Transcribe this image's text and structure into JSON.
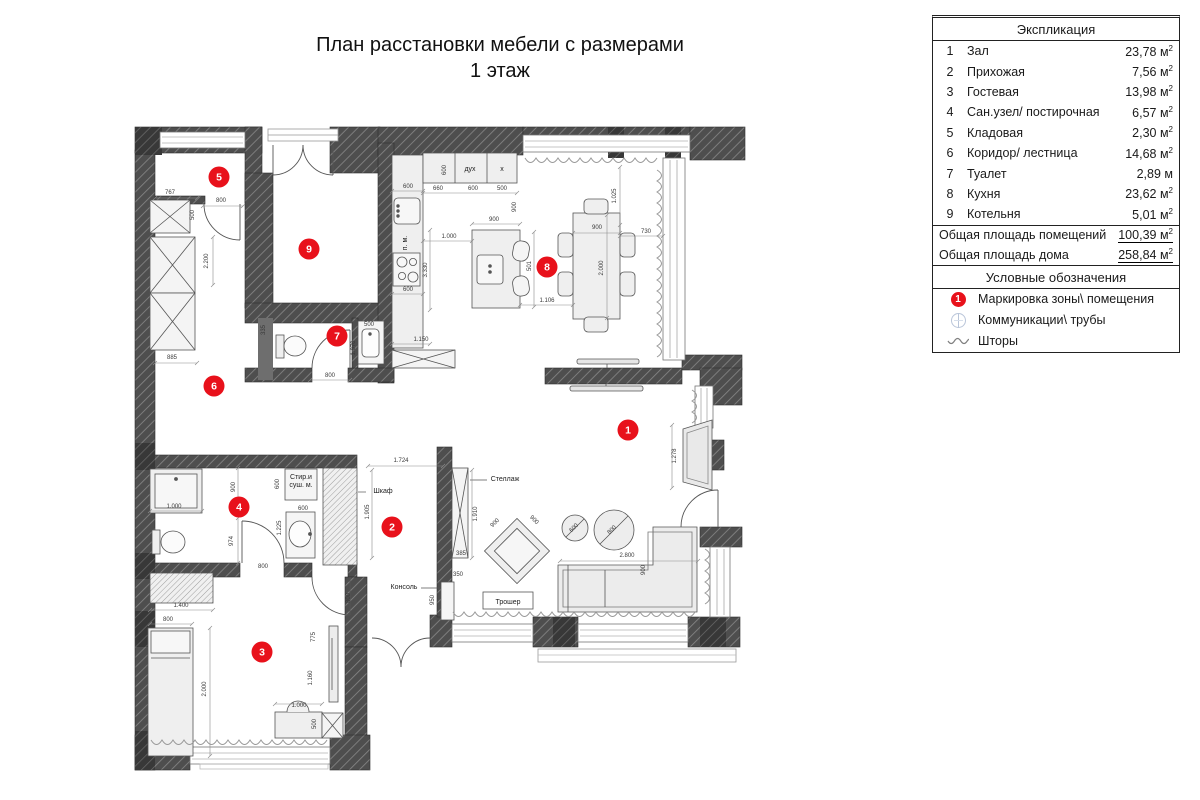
{
  "title": {
    "line1": "План расстановки мебели с размерами",
    "line2": "1 этаж"
  },
  "explication": {
    "header": "Экспликация",
    "rows": [
      {
        "num": "1",
        "name": "Зал",
        "area": "23,78",
        "unit": "м",
        "sup": "2"
      },
      {
        "num": "2",
        "name": "Прихожая",
        "area": "7,56",
        "unit": "м",
        "sup": "2"
      },
      {
        "num": "3",
        "name": "Гостевая",
        "area": "13,98",
        "unit": "м",
        "sup": "2"
      },
      {
        "num": "4",
        "name": "Сан.узел/ постирочная",
        "area": "6,57",
        "unit": "м",
        "sup": "2"
      },
      {
        "num": "5",
        "name": "Кладовая",
        "area": "2,30",
        "unit": "м",
        "sup": "2"
      },
      {
        "num": "6",
        "name": "Коридор/ лестница",
        "area": "14,68",
        "unit": "м",
        "sup": "2"
      },
      {
        "num": "7",
        "name": "Туалет",
        "area": "2,89",
        "unit": "м",
        "sup": ""
      },
      {
        "num": "8",
        "name": "Кухня",
        "area": "23,62",
        "unit": "м",
        "sup": "2"
      },
      {
        "num": "9",
        "name": "Котельня",
        "area": "5,01",
        "unit": "м",
        "sup": "2"
      }
    ],
    "totals": [
      {
        "label": "Общая площадь помещений",
        "value": "100,39",
        "unit": "м",
        "sup": "2"
      },
      {
        "label": "Общая площадь дома",
        "value": "258,84",
        "unit": "м",
        "sup": "2"
      }
    ]
  },
  "legend": {
    "header": "Условные обозначения",
    "items": [
      {
        "icon": "zone-marker",
        "label": "Маркировка зоны\\ помещения"
      },
      {
        "icon": "pipes",
        "label": "Коммуникации\\ трубы"
      },
      {
        "icon": "curtains",
        "label": "Шторы"
      }
    ]
  },
  "colors": {
    "zone_marker": "#e8111b",
    "wall": "#4e4e4e",
    "furniture": "#efefef"
  },
  "plan": {
    "zones": [
      {
        "n": "1",
        "x": 628,
        "y": 430
      },
      {
        "n": "2",
        "x": 392,
        "y": 527
      },
      {
        "n": "3",
        "x": 262,
        "y": 652
      },
      {
        "n": "4",
        "x": 239,
        "y": 507
      },
      {
        "n": "5",
        "x": 219,
        "y": 177
      },
      {
        "n": "6",
        "x": 214,
        "y": 386
      },
      {
        "n": "7",
        "x": 337,
        "y": 336
      },
      {
        "n": "8",
        "x": 547,
        "y": 267
      },
      {
        "n": "9",
        "x": 309,
        "y": 249
      }
    ],
    "labels": [
      {
        "t": "Шкаф",
        "x": 383,
        "y": 493,
        "r": 0
      },
      {
        "t": "Консоль",
        "x": 404,
        "y": 589,
        "r": 0
      },
      {
        "t": "Стеллаж",
        "x": 505,
        "y": 481,
        "r": 0
      },
      {
        "t": "Трошер",
        "x": 508,
        "y": 604,
        "r": 0
      },
      {
        "t": "дух",
        "x": 470,
        "y": 171,
        "r": 0
      },
      {
        "t": "х",
        "x": 502,
        "y": 171,
        "r": 0
      },
      {
        "t": "Стир.и",
        "x": 301,
        "y": 479,
        "r": 0
      },
      {
        "t": "суш. м.",
        "x": 301,
        "y": 487,
        "r": 0
      },
      {
        "t": "п. м.",
        "x": 407,
        "y": 243,
        "r": -90
      }
    ],
    "dims": [
      {
        "t": "767",
        "x": 170,
        "y": 194,
        "r": 0
      },
      {
        "t": "800",
        "x": 221,
        "y": 202,
        "r": 0
      },
      {
        "t": "500",
        "x": 194,
        "y": 215,
        "r": -90
      },
      {
        "t": "2.200",
        "x": 208,
        "y": 261,
        "r": -90
      },
      {
        "t": "885",
        "x": 172,
        "y": 359,
        "r": 0
      },
      {
        "t": "335",
        "x": 265,
        "y": 330,
        "r": -90
      },
      {
        "t": "800",
        "x": 330,
        "y": 377,
        "r": 0
      },
      {
        "t": "500",
        "x": 369,
        "y": 326,
        "r": 0
      },
      {
        "t": "1.070",
        "x": 355,
        "y": 348,
        "r": -90
      },
      {
        "t": "600",
        "x": 408,
        "y": 188,
        "r": 0
      },
      {
        "t": "660",
        "x": 438,
        "y": 190,
        "r": 0
      },
      {
        "t": "600",
        "x": 473,
        "y": 190,
        "r": 0
      },
      {
        "t": "500",
        "x": 502,
        "y": 190,
        "r": 0
      },
      {
        "t": "600",
        "x": 446,
        "y": 170,
        "r": -90
      },
      {
        "t": "900",
        "x": 516,
        "y": 207,
        "r": -90
      },
      {
        "t": "900",
        "x": 494,
        "y": 221,
        "r": 0
      },
      {
        "t": "1.000",
        "x": 449,
        "y": 238,
        "r": 0
      },
      {
        "t": "3.330",
        "x": 427,
        "y": 270,
        "r": -90
      },
      {
        "t": "600",
        "x": 408,
        "y": 291,
        "r": 0
      },
      {
        "t": "1.150",
        "x": 421,
        "y": 341,
        "r": 0
      },
      {
        "t": "900",
        "x": 597,
        "y": 229,
        "r": 0
      },
      {
        "t": "730",
        "x": 646,
        "y": 233,
        "r": 0
      },
      {
        "t": "2.000",
        "x": 603,
        "y": 268,
        "r": -90
      },
      {
        "t": "1.025",
        "x": 616,
        "y": 196,
        "r": -90
      },
      {
        "t": "501",
        "x": 531,
        "y": 266,
        "r": -90
      },
      {
        "t": "1.106",
        "x": 547,
        "y": 302,
        "r": 0
      },
      {
        "t": "1.278",
        "x": 676,
        "y": 456,
        "r": -90
      },
      {
        "t": "1.910",
        "x": 477,
        "y": 514,
        "r": -90
      },
      {
        "t": "385",
        "x": 461,
        "y": 555,
        "r": 0
      },
      {
        "t": "350",
        "x": 458,
        "y": 576,
        "r": 0
      },
      {
        "t": "950",
        "x": 434,
        "y": 600,
        "r": -90
      },
      {
        "t": "900",
        "x": 496,
        "y": 524,
        "r": -45
      },
      {
        "t": "900",
        "x": 533,
        "y": 521,
        "r": 45
      },
      {
        "t": "2.800",
        "x": 627,
        "y": 557,
        "r": 0
      },
      {
        "t": "900",
        "x": 645,
        "y": 570,
        "r": -90
      },
      {
        "t": "600",
        "x": 575,
        "y": 529,
        "r": -45
      },
      {
        "t": "800",
        "x": 613,
        "y": 531,
        "r": -45
      },
      {
        "t": "1.724",
        "x": 401,
        "y": 462,
        "r": 0
      },
      {
        "t": "1.905",
        "x": 369,
        "y": 512,
        "r": -90
      },
      {
        "t": "800",
        "x": 350,
        "y": 598,
        "r": -90
      },
      {
        "t": "1.000",
        "x": 174,
        "y": 508,
        "r": 0
      },
      {
        "t": "900",
        "x": 235,
        "y": 487,
        "r": -90
      },
      {
        "t": "974",
        "x": 233,
        "y": 541,
        "r": -90
      },
      {
        "t": "600",
        "x": 279,
        "y": 484,
        "r": -90
      },
      {
        "t": "600",
        "x": 303,
        "y": 510,
        "r": 0
      },
      {
        "t": "1.225",
        "x": 281,
        "y": 528,
        "r": -90
      },
      {
        "t": "800",
        "x": 263,
        "y": 568,
        "r": 0
      },
      {
        "t": "1.400",
        "x": 181,
        "y": 607,
        "r": 0
      },
      {
        "t": "800",
        "x": 168,
        "y": 621,
        "r": 0
      },
      {
        "t": "2.000",
        "x": 206,
        "y": 689,
        "r": -90
      },
      {
        "t": "775",
        "x": 315,
        "y": 637,
        "r": -90
      },
      {
        "t": "1.160",
        "x": 312,
        "y": 678,
        "r": -90
      },
      {
        "t": "500",
        "x": 316,
        "y": 724,
        "r": -90
      },
      {
        "t": "1.000",
        "x": 299,
        "y": 707,
        "r": 0
      }
    ]
  }
}
